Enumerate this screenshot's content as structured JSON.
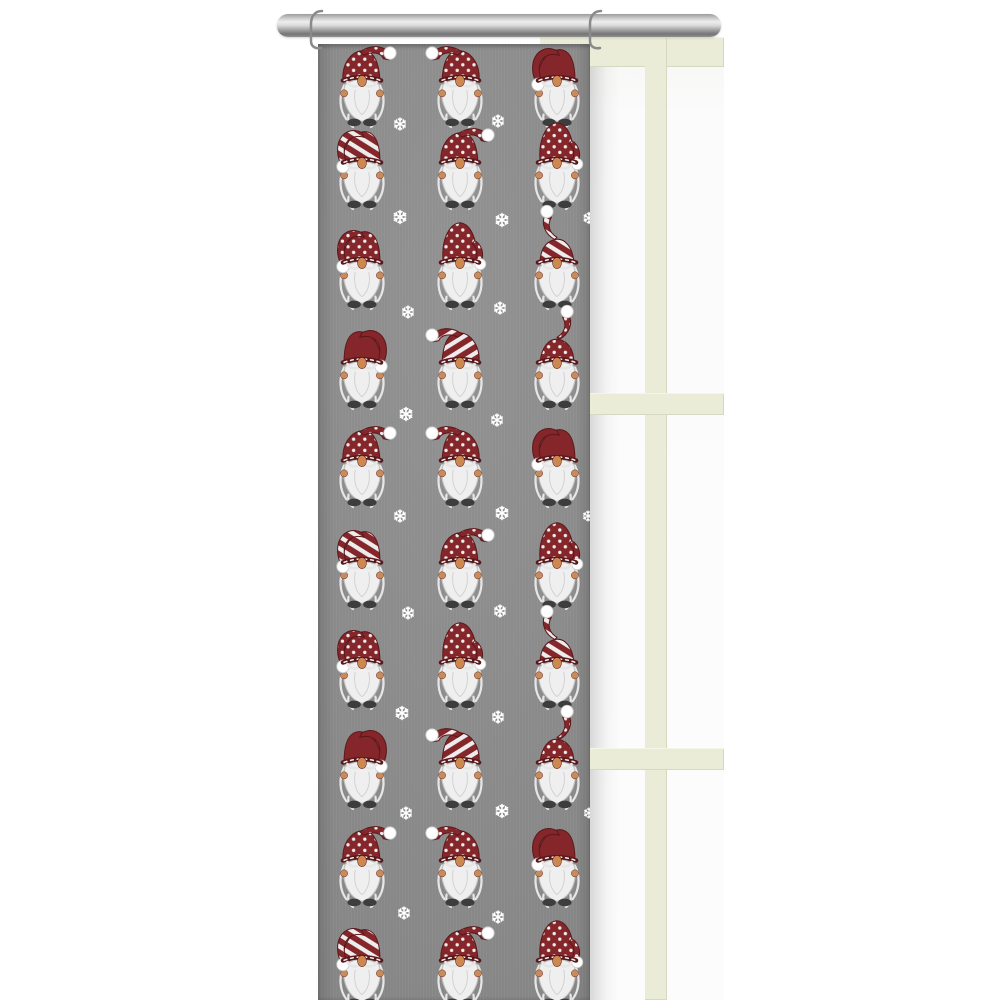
{
  "meta": {
    "description": "Gray panel curtain with Christmas gnome and snowflake pattern hanging from a chrome rod in front of a cream window frame"
  },
  "palette": {
    "background": "#ffffff",
    "fabric_gray": "#8e8e8e",
    "hat_red": "#85262a",
    "hat_outline": "#5a181b",
    "stripe_white": "#ededed",
    "beard_white": "#efefef",
    "beard_stroke": "#c2c2c2",
    "wisp_white": "#e6e6e6",
    "nose_tan": "#cd8850",
    "hand_tan": "#c78c5a",
    "boot_gray": "#3d3d3d",
    "snow_white": "#ffffff",
    "frame_cream": "#eaecd7",
    "glass_white": "#fbfbfb",
    "rod_silver": "#c6c6c6",
    "hook_gray": "#8a8a8a"
  },
  "rod": {
    "x": 277,
    "y": 14,
    "width": 444,
    "height": 23,
    "hooks_x": [
      313,
      592
    ]
  },
  "window": {
    "x": 540,
    "y": 37,
    "width": 184,
    "height": 963,
    "top_bar_height": 30,
    "mullion_x": 645,
    "mullion_width": 22,
    "horizontal_bars_y": [
      393,
      748
    ],
    "horizontal_bar_height": 22
  },
  "curtain": {
    "x": 318,
    "y": 44,
    "width": 272,
    "height": 956
  },
  "pattern": {
    "columns_x": [
      362,
      460,
      557
    ],
    "gnome_scale": 1.12,
    "rows": [
      {
        "y": 90,
        "variants": [
          "dotted-flop-right",
          "dotted-flop-left",
          "solid-droop-left"
        ]
      },
      {
        "y": 172,
        "variants": [
          "striped-droop-left",
          "dotted-flop-right",
          "dotted-tall-curl"
        ]
      },
      {
        "y": 272,
        "variants": [
          "dotted-droop-left",
          "dotted-tall-curl",
          "striped-swoop-up"
        ]
      },
      {
        "y": 372,
        "variants": [
          "solid-droop-right",
          "striped-flop-left",
          "dotted-swoop-up-right"
        ]
      },
      {
        "y": 470,
        "variants": [
          "dotted-flop-right",
          "dotted-flop-left",
          "solid-droop-left"
        ]
      },
      {
        "y": 572,
        "variants": [
          "striped-droop-left",
          "dotted-flop-right",
          "dotted-tall-curl"
        ]
      },
      {
        "y": 672,
        "variants": [
          "dotted-droop-left",
          "dotted-tall-curl",
          "striped-swoop-up"
        ]
      },
      {
        "y": 772,
        "variants": [
          "solid-droop-right",
          "striped-flop-left",
          "dotted-swoop-up-right"
        ]
      },
      {
        "y": 870,
        "variants": [
          "dotted-flop-right",
          "dotted-flop-left",
          "solid-droop-left"
        ]
      },
      {
        "y": 970,
        "variants": [
          "striped-droop-left",
          "dotted-flop-right",
          "dotted-tall-curl"
        ]
      }
    ],
    "snowflakes": [
      {
        "x": 400,
        "y": 124,
        "s": 12
      },
      {
        "x": 498,
        "y": 121,
        "s": 12
      },
      {
        "x": 400,
        "y": 217,
        "s": 13
      },
      {
        "x": 502,
        "y": 220,
        "s": 13
      },
      {
        "x": 589,
        "y": 218,
        "s": 11
      },
      {
        "x": 408,
        "y": 312,
        "s": 12
      },
      {
        "x": 500,
        "y": 308,
        "s": 12
      },
      {
        "x": 406,
        "y": 414,
        "s": 13
      },
      {
        "x": 497,
        "y": 420,
        "s": 12
      },
      {
        "x": 400,
        "y": 516,
        "s": 12
      },
      {
        "x": 502,
        "y": 513,
        "s": 13
      },
      {
        "x": 588,
        "y": 516,
        "s": 10
      },
      {
        "x": 408,
        "y": 613,
        "s": 12
      },
      {
        "x": 500,
        "y": 611,
        "s": 12
      },
      {
        "x": 402,
        "y": 713,
        "s": 13
      },
      {
        "x": 498,
        "y": 717,
        "s": 12
      },
      {
        "x": 406,
        "y": 813,
        "s": 12
      },
      {
        "x": 502,
        "y": 811,
        "s": 13
      },
      {
        "x": 589,
        "y": 813,
        "s": 10
      },
      {
        "x": 404,
        "y": 913,
        "s": 12
      },
      {
        "x": 498,
        "y": 917,
        "s": 12
      }
    ]
  }
}
